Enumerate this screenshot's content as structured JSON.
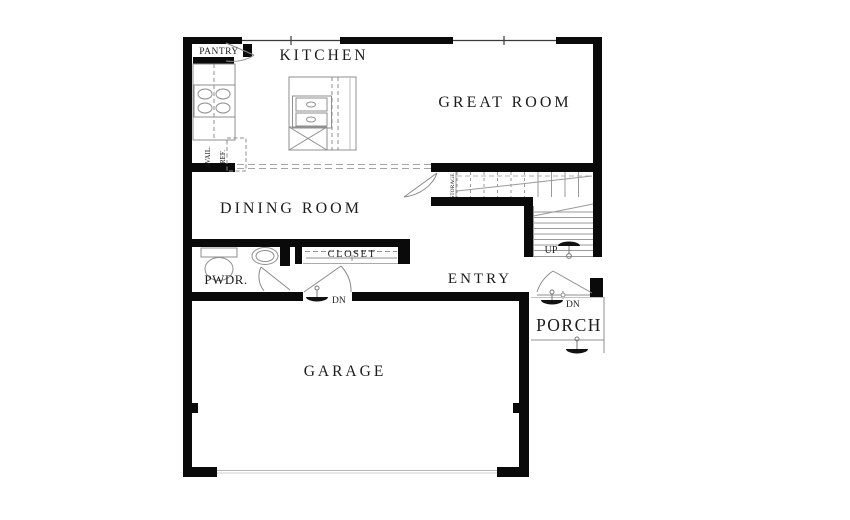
{
  "rooms": {
    "kitchen": "KITCHEN",
    "great_room": "GREAT ROOM",
    "dining_room": "DINING ROOM",
    "entry": "ENTRY",
    "garage": "GARAGE",
    "porch": "PORCH",
    "powder_room": "PWDR.",
    "closet": "CLOSET",
    "pantry": "PANTRY",
    "storage": "STORAGE"
  },
  "stairs": {
    "up_label": "UP"
  },
  "steps": {
    "dn_entry_garage": "DN",
    "dn_front_door": "DN"
  },
  "appliances": {
    "avail_line": "AVAIL.",
    "ref_line": "REF."
  },
  "colors": {
    "wall": "#0a0a0a",
    "fixture_line": "#8f8f8f",
    "text": "#1c1c1c",
    "background": "#ffffff"
  }
}
